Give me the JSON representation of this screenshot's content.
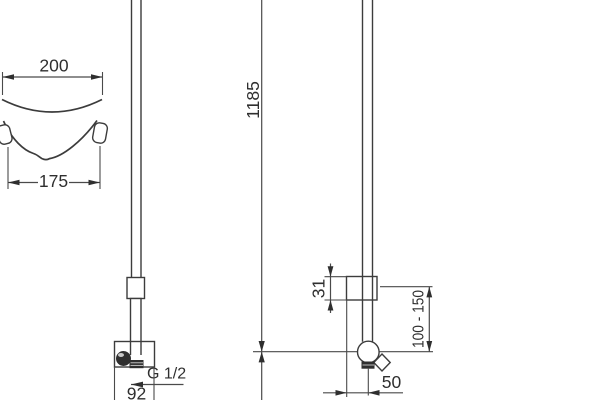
{
  "drawing": {
    "type": "technical-dimension-drawing",
    "subject": "shower rail set: hand shower with wall holder and soap dish (left), sliding rail with wall elbow (right)",
    "background_color": "#ffffff",
    "line_color": "#3c3c3c",
    "labels": {
      "dish_top_width": "200",
      "dish_bottom_width": "175",
      "rail_height": "1185",
      "slider_height": "31",
      "wall_elbow_range": "100 - 150",
      "wall_elbow_offset": "50",
      "thread_size": "G 1/2",
      "holder_width": "92"
    }
  }
}
